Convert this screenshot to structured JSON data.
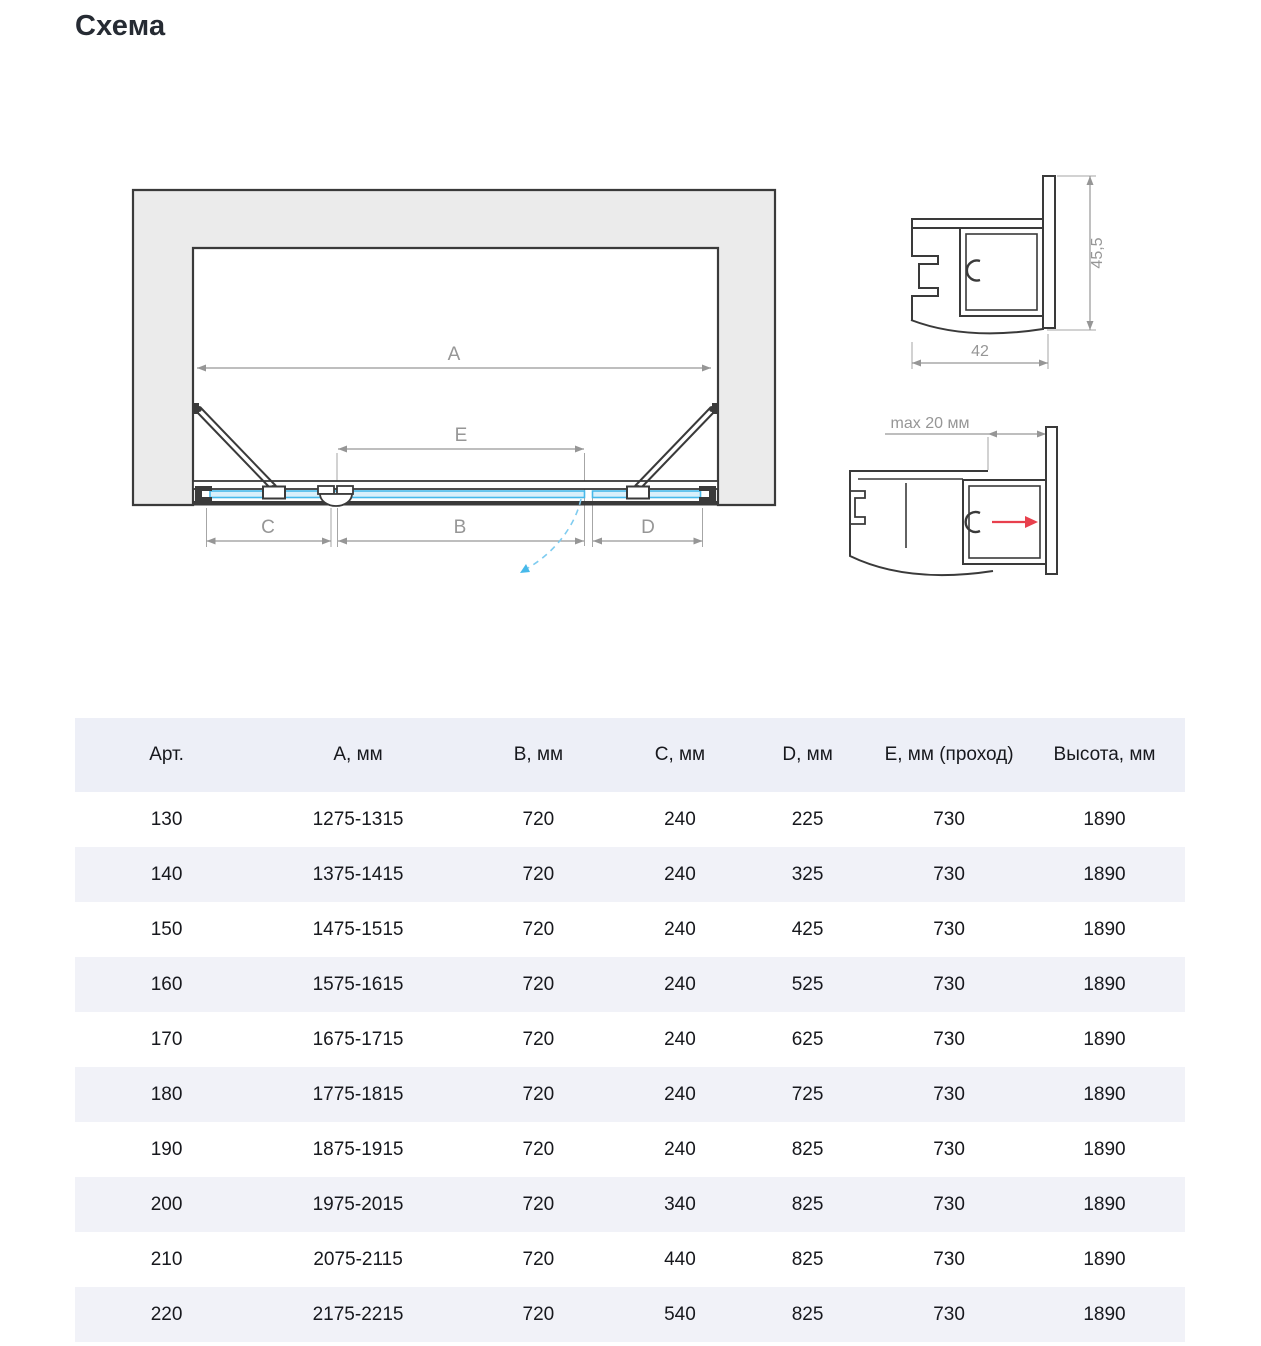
{
  "page": {
    "title": "Схема"
  },
  "colors": {
    "outline_dark": "#3a3a3a",
    "wall_fill": "#ebebeb",
    "glass_blue": "#47b9ea",
    "glass_fill": "#d9f0fb",
    "dimension_gray": "#969696",
    "swing_arc_blue": "#7fccf0",
    "arrow_red": "#e8404d",
    "table_header_bg": "#edeff7",
    "table_stripe": "#f1f2f8",
    "text_dark": "#17181d",
    "title_color": "#262b33"
  },
  "diagram": {
    "dimension_labels": {
      "a": "A",
      "b": "B",
      "c": "C",
      "d": "D",
      "e": "E"
    },
    "profile_top": {
      "width": "42",
      "height": "45,5"
    },
    "profile_bottom": {
      "max_adjustment": "max 20 мм"
    }
  },
  "table": {
    "columns": [
      "Арт.",
      "А, мм",
      "В, мм",
      "С, мм",
      "D, мм",
      "Е, мм (проход)",
      "Высота, мм"
    ],
    "row_keys": [
      "art",
      "a",
      "b",
      "c",
      "d",
      "e",
      "height"
    ],
    "rows": [
      {
        "art": "130",
        "a": "1275-1315",
        "b": "720",
        "c": "240",
        "d": "225",
        "e": "730",
        "height": "1890"
      },
      {
        "art": "140",
        "a": "1375-1415",
        "b": "720",
        "c": "240",
        "d": "325",
        "e": "730",
        "height": "1890"
      },
      {
        "art": "150",
        "a": "1475-1515",
        "b": "720",
        "c": "240",
        "d": "425",
        "e": "730",
        "height": "1890"
      },
      {
        "art": "160",
        "a": "1575-1615",
        "b": "720",
        "c": "240",
        "d": "525",
        "e": "730",
        "height": "1890"
      },
      {
        "art": "170",
        "a": "1675-1715",
        "b": "720",
        "c": "240",
        "d": "625",
        "e": "730",
        "height": "1890"
      },
      {
        "art": "180",
        "a": "1775-1815",
        "b": "720",
        "c": "240",
        "d": "725",
        "e": "730",
        "height": "1890"
      },
      {
        "art": "190",
        "a": "1875-1915",
        "b": "720",
        "c": "240",
        "d": "825",
        "e": "730",
        "height": "1890"
      },
      {
        "art": "200",
        "a": "1975-2015",
        "b": "720",
        "c": "340",
        "d": "825",
        "e": "730",
        "height": "1890"
      },
      {
        "art": "210",
        "a": "2075-2115",
        "b": "720",
        "c": "440",
        "d": "825",
        "e": "730",
        "height": "1890"
      },
      {
        "art": "220",
        "a": "2175-2215",
        "b": "720",
        "c": "540",
        "d": "825",
        "e": "730",
        "height": "1890"
      }
    ]
  }
}
